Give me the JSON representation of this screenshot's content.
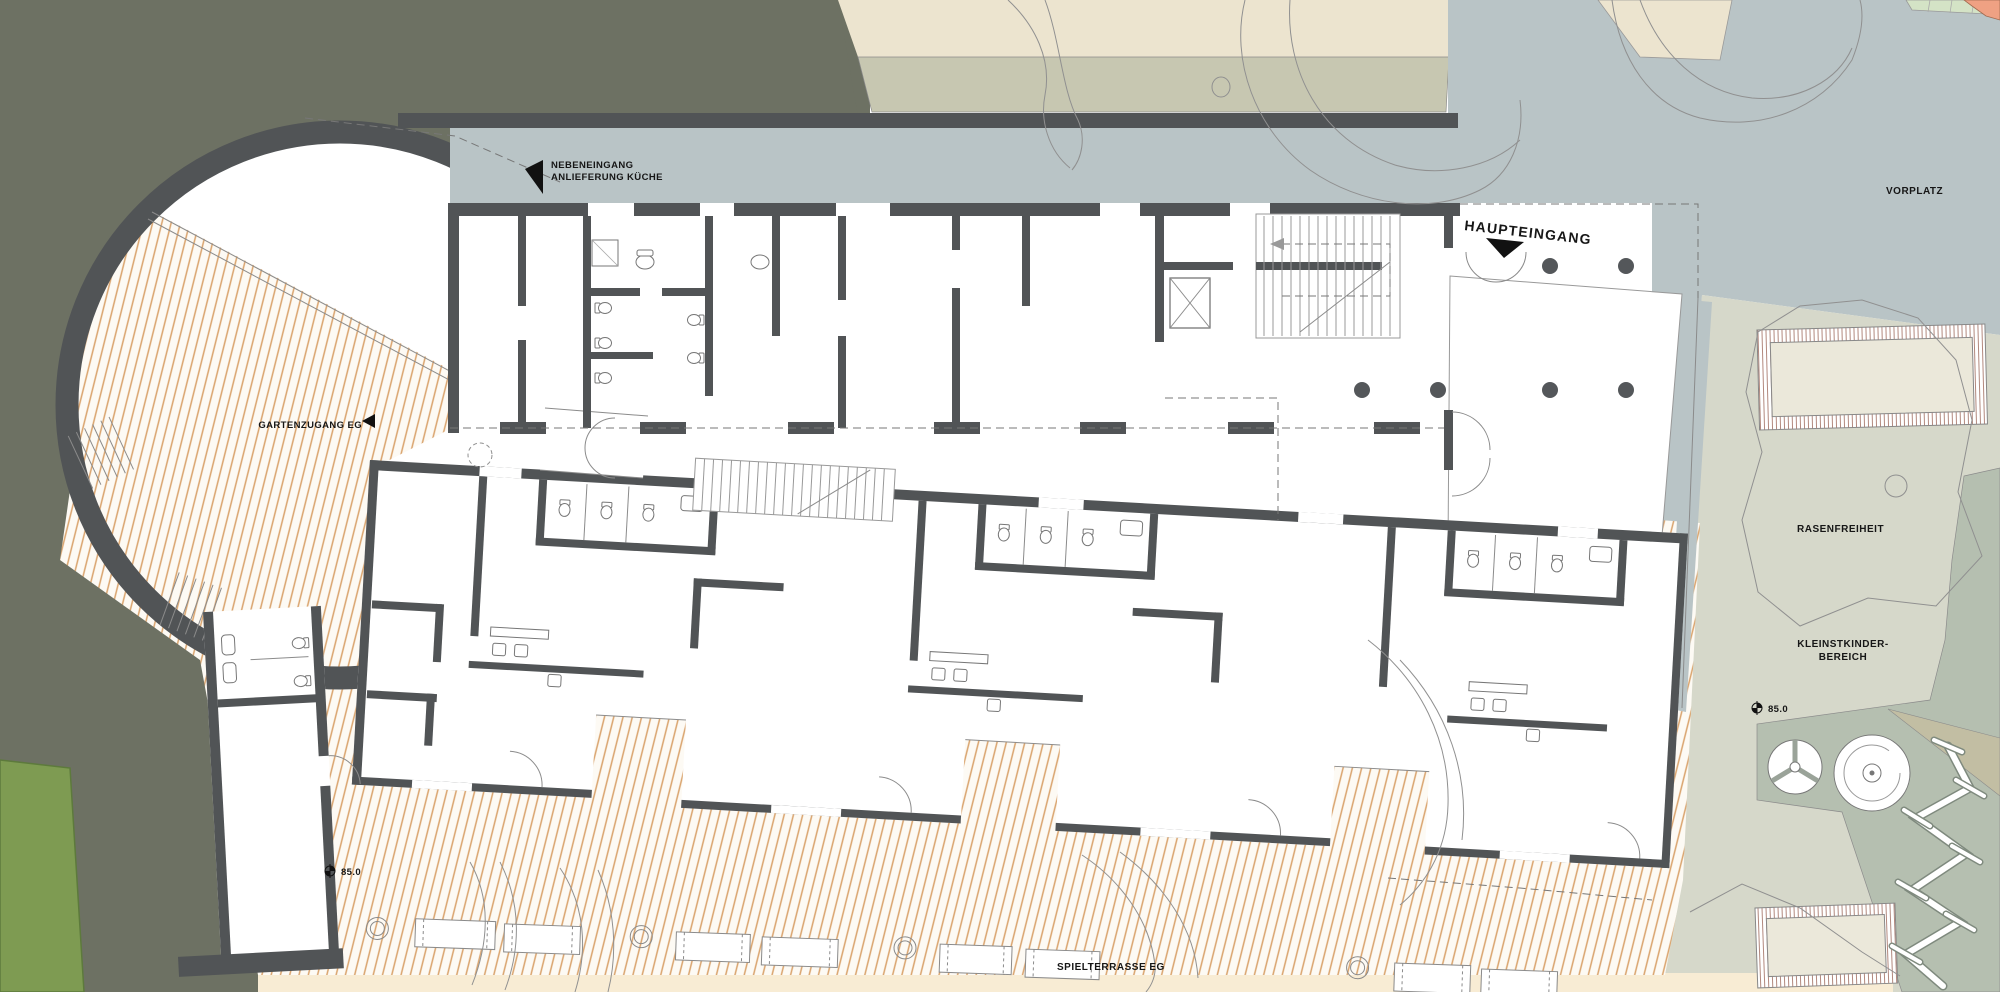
{
  "plan": {
    "labels": {
      "side_entrance": {
        "line1": "NEBENEINGANG",
        "line2": "ANLIEFERUNG KÜCHE"
      },
      "main_entrance": "HAUPTEINGANG",
      "garden_access": "GARTENZUGANG EG",
      "forecourt": "VORPLATZ",
      "lawn": "RASENFREIHEIT",
      "toddler_area": {
        "line1": "KLEINSTKINDER-",
        "line2": "BEREICH"
      },
      "play_terrace": "SPIELTERRASSE EG",
      "level_marker_garden": "85.0",
      "level_marker_terrace": "85.0"
    },
    "colors": {
      "site_dark_olive": "#6d7163",
      "paving_blue_gray": "#b9c4c6",
      "band_cream": "#ece4cf",
      "band_sage": "#c7c7b1",
      "park_light": "#d6d8ca",
      "play_zone_sage": "#b5bfb0",
      "wedge_khaki": "#c2bea3",
      "sand_inner": "#ebe8da",
      "terrace_stripe": "#d9a36c",
      "terrace_base": "#fdfaf4",
      "bottom_sand_strip": "#f8ecd4",
      "grass_strip": "#7e9b52",
      "wall_dark": "#515456",
      "path_salmon": "#efa183",
      "grid_green": "#d4e3c6"
    }
  }
}
